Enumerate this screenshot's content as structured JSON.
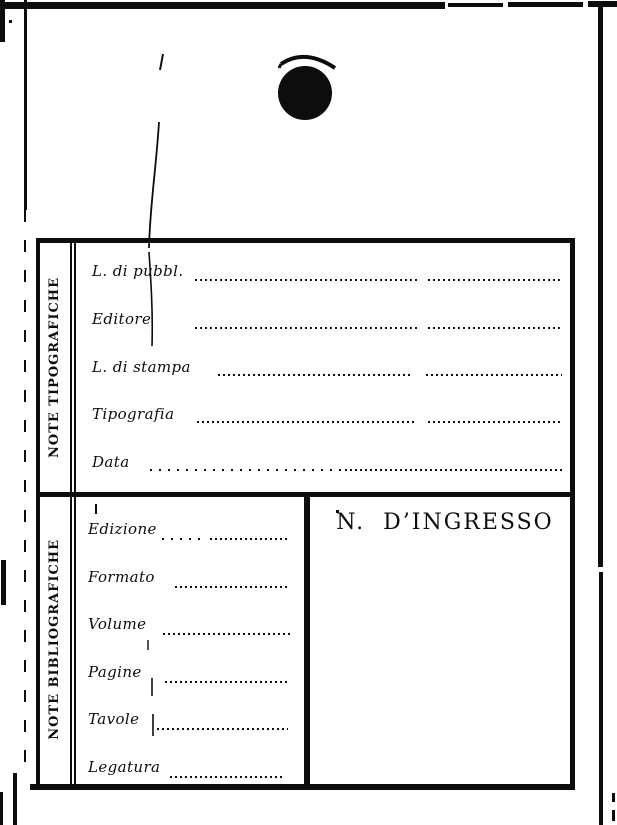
{
  "colors": {
    "ink": "#0d0d0d",
    "paper": "#ffffff"
  },
  "card": {
    "typographic_section": {
      "sidebar_label": "NOTE TIPOGRAFICHE",
      "fields": [
        {
          "label": "L. di pubbl.",
          "value": ""
        },
        {
          "label": "Editore",
          "value": ""
        },
        {
          "label": "L. di stampa",
          "value": ""
        },
        {
          "label": "Tipografia",
          "value": ""
        },
        {
          "label": "Data",
          "value": ""
        }
      ]
    },
    "bibliographic_section": {
      "sidebar_label": "NOTE BIBLIOGRAFICHE",
      "fields": [
        {
          "label": "Edizione",
          "value": ""
        },
        {
          "label": "Formato",
          "value": ""
        },
        {
          "label": "Volume",
          "value": ""
        },
        {
          "label": "Pagine",
          "value": ""
        },
        {
          "label": "Tavole",
          "value": ""
        },
        {
          "label": "Legatura",
          "value": ""
        }
      ],
      "entry_number_heading": "N.  D’INGRESSO"
    }
  }
}
